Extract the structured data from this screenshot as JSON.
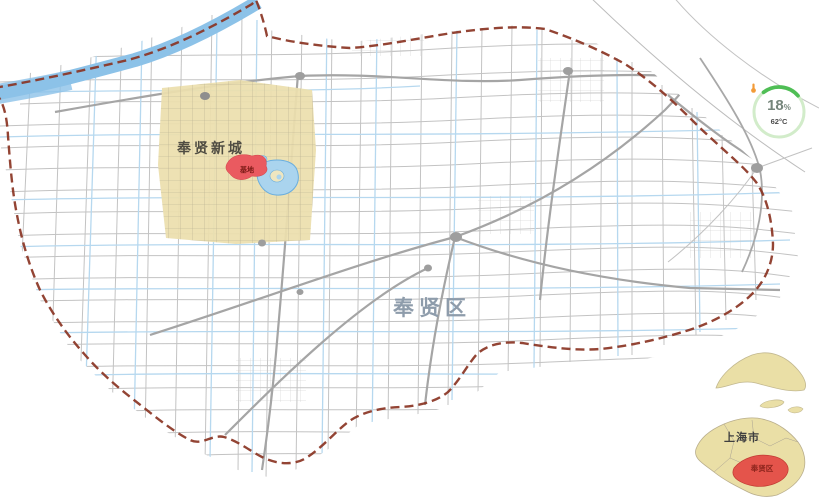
{
  "labels": {
    "new_city": "奉贤新城",
    "district": "奉贤区",
    "base": "基地"
  },
  "badge": {
    "percent": "18",
    "percent_sign": "%",
    "temperature": "62°C"
  },
  "inset": {
    "city": "上海市",
    "district": "奉贤区"
  },
  "colors": {
    "boundary_dash": "#8a3423",
    "river": "#8cc2e8",
    "canal": "#b6d8ef",
    "road_thin": "#c3c3c3",
    "road_thick": "#a5a5a5",
    "junction": "#9e9e9e",
    "new_city_fill": "#ecdfad",
    "base_marker_fill": "#ea5a60",
    "lake_fill": "#aad4ee",
    "district_label": "#8e9cab",
    "badge_ring": "#d2ecca",
    "badge_arc": "#4fbe55",
    "badge_temp_icon": "#f29b38",
    "inset_land": "#eadfa6",
    "inset_highlight": "#e4544b"
  }
}
